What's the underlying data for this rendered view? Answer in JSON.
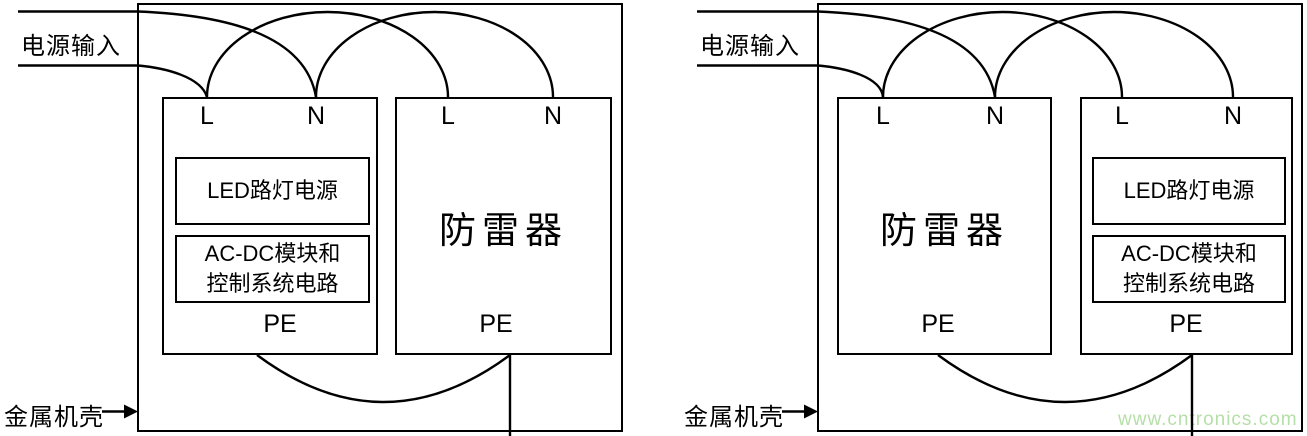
{
  "watermark": {
    "text": "www.cntronics.com",
    "color": "#b5dfa8"
  },
  "colors": {
    "line": "#000000",
    "background": "#ffffff"
  },
  "diagrams": [
    {
      "side": "left",
      "power_input_label": "电源输入",
      "metal_case_label": "金属机壳",
      "led_unit": {
        "terminal_l": "L",
        "terminal_n": "N",
        "terminal_pe": "PE",
        "module_led": "LED路灯电源",
        "module_acdc_line1": "AC-DC模块和",
        "module_acdc_line2": "控制系统电路"
      },
      "surge_protector": {
        "terminal_l": "L",
        "terminal_n": "N",
        "terminal_pe": "PE",
        "label": "防雷器"
      }
    },
    {
      "side": "right",
      "power_input_label": "电源输入",
      "metal_case_label": "金属机壳",
      "surge_protector": {
        "terminal_l": "L",
        "terminal_n": "N",
        "terminal_pe": "PE",
        "label": "防雷器"
      },
      "led_unit": {
        "terminal_l": "L",
        "terminal_n": "N",
        "terminal_pe": "PE",
        "module_led": "LED路灯电源",
        "module_acdc_line1": "AC-DC模块和",
        "module_acdc_line2": "控制系统电路"
      }
    }
  ]
}
